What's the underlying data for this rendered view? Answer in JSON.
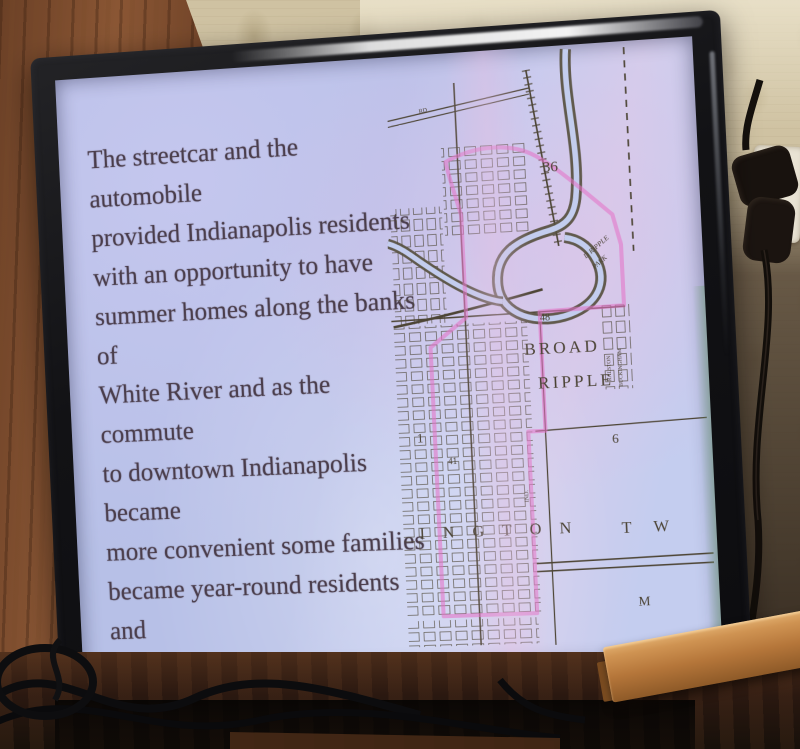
{
  "tv": {
    "brand": "SAMSUNG"
  },
  "slide": {
    "lines": [
      "The streetcar and the automobile",
      "provided Indianapolis residents",
      "with an opportunity to have",
      "summer homes along the banks of",
      "White River and as the commute",
      "to downtown Indianapolis became",
      "more convenient some families",
      "became year-round residents and",
      "the Broad Ripple area grew as",
      "others established homes in the",
      "area."
    ],
    "full_text": "The streetcar and the automobile provided Indianapolis residents with an opportunity to have summer homes along the banks of White River and as the commute to downtown Indianapolis became more convenient some families became year-round residents and the Broad Ripple area grew as others established homes in the area."
  },
  "map": {
    "labels": {
      "rd": "RD",
      "section_36": "36",
      "elevation_48": "48",
      "broad": "BROAD",
      "ripple": "RIPPLE",
      "section_1": "1",
      "section_6": "6",
      "marker_41": "41",
      "park_line1": "D RIPPLE",
      "park_line2": "PARK",
      "township": "I N G T O N",
      "township_tw": "T W",
      "letter_m": "M",
      "street_ralston": "RALSTON",
      "street_buckingham": "BUCKINGHAM",
      "street_ind": "IND."
    }
  },
  "colors": {
    "slide_background": "#c3cdee",
    "slide_text": "#4a3d4b",
    "map_line": "#4d4535",
    "boundary_pink": "#e473c8",
    "park_label_pink": "#d966b8",
    "tv_bezel": "#17171a",
    "logo_text": "#d8d2c4",
    "wallpaper": "#cfc2a2",
    "wood_panel": "#7a4a2c",
    "rail_wood": "#c08040"
  }
}
